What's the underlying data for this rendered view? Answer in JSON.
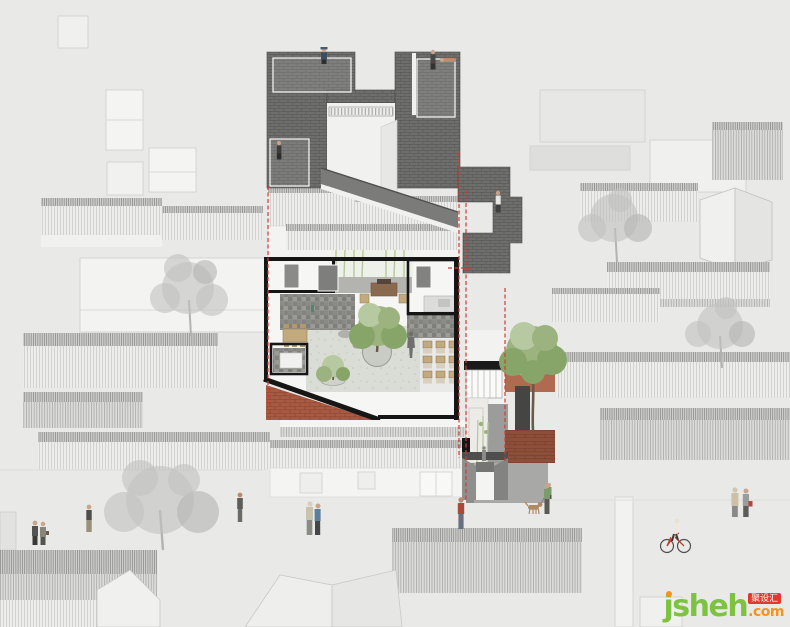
{
  "meta": {
    "description": "Architectural sectional axonometric (plan-oblique cutaway) of a renovated Beijing hutong courtyard house set among faint grey neighbourhood rooftops",
    "canvas": {
      "width": 790,
      "height": 627
    }
  },
  "watermark": {
    "brand": "jsheh",
    "tld": ".com",
    "badge": "聚设汇"
  },
  "palette": {
    "background": "#e9eae7",
    "dark_roof_tile": "#6e6e6c",
    "poche_black": "#161616",
    "section_cut_red": "#d8392e",
    "brick_red": "#a85a42",
    "terracotta_floor": "#b5674f",
    "tree_green": "#87a569",
    "bamboo_green": "#b9c79e",
    "background_tree_gray": "#c2c2c0",
    "wood_furniture": "#c2a97e",
    "watermark_green": "#7ec242",
    "watermark_orange": "#f6921e",
    "watermark_red": "#e03a2c"
  },
  "annotations": {
    "section_cut_lines": [
      {
        "id": "left-cut",
        "orientation": "vertical",
        "style": "red dashed"
      },
      {
        "id": "right-cut-a",
        "orientation": "vertical",
        "style": "red dashed"
      },
      {
        "id": "right-cut-b",
        "orientation": "vertical",
        "style": "red dashed"
      },
      {
        "id": "far-right-cut",
        "orientation": "vertical",
        "style": "red dashed"
      }
    ]
  },
  "scene": {
    "structures": [
      {
        "id": "dark-tiled-roof",
        "description": "dark grey tile roof of the renovated house, U-shaped around a courtyard opening, with stepped extension to the lower east wing"
      },
      {
        "id": "courtyard-plan-cutaway",
        "description": "cut-open floor plan: white rooms, black poche walls, stone wall bands, central gravel courtyard with tree planter, dining room with chair rows, terracotta floored hall"
      },
      {
        "id": "east-wing-section",
        "description": "section through entry lane: glazed wall, bamboo, brick paving, street gate flanked by grey walls"
      },
      {
        "id": "background-hutong-roofs",
        "description": "faint grey hatched pitched roofs and white building boxes of the surrounding hutong fabric"
      }
    ],
    "trees": [
      {
        "id": "courtyard-tree",
        "color": "green",
        "location": "center of main courtyard in round planter"
      },
      {
        "id": "small-courtyard-tree",
        "color": "green",
        "location": "south-west corner of courtyard"
      },
      {
        "id": "east-court-tree",
        "color": "green",
        "location": "east wing brick court"
      },
      {
        "id": "bamboo-strips",
        "color": "green",
        "location": "north verandah and entry lane"
      },
      {
        "id": "bg-tree-left",
        "color": "gray",
        "location": "left neighbourhood block"
      },
      {
        "id": "bg-tree-right-upper",
        "color": "gray",
        "location": "upper right neighbourhood block"
      },
      {
        "id": "bg-tree-right-lower",
        "color": "gray",
        "location": "right of east wing"
      },
      {
        "id": "bg-tree-street",
        "color": "gray",
        "location": "over street, lower left"
      }
    ],
    "figures": [
      {
        "id": "roof-sitter-left",
        "pose": "sitting on ridge, hat"
      },
      {
        "id": "roof-stander-right-top",
        "pose": "standing on upper roof"
      },
      {
        "id": "roof-lounger-right-top",
        "pose": "lying on upper roof"
      },
      {
        "id": "roof-climber-left",
        "pose": "on lower left roof pitch"
      },
      {
        "id": "roof-stander-east-step",
        "pose": "standing on stepped east roof"
      },
      {
        "id": "plan-visitor",
        "pose": "grey silhouette standing in dining room"
      },
      {
        "id": "entry-lane-visitor",
        "pose": "small figure in entry lane"
      },
      {
        "id": "east-court-sitter",
        "pose": "seated at east court edge"
      },
      {
        "id": "street-couple-left",
        "pose": "two pedestrians, lower left"
      },
      {
        "id": "street-man-left",
        "pose": "walking man"
      },
      {
        "id": "street-woman-center-left",
        "pose": "standing woman"
      },
      {
        "id": "street-couple-center",
        "pose": "embracing couple by gate"
      },
      {
        "id": "street-red-shirt-man",
        "pose": "man in red shirt near entrance"
      },
      {
        "id": "dog-walker",
        "pose": "person walking a dog"
      },
      {
        "id": "dog",
        "pose": "tan dog on leash"
      },
      {
        "id": "elderly-couple-right",
        "pose": "couple walking, one with red bag"
      },
      {
        "id": "cyclist",
        "pose": "riding red bicycle, lower right"
      }
    ]
  }
}
